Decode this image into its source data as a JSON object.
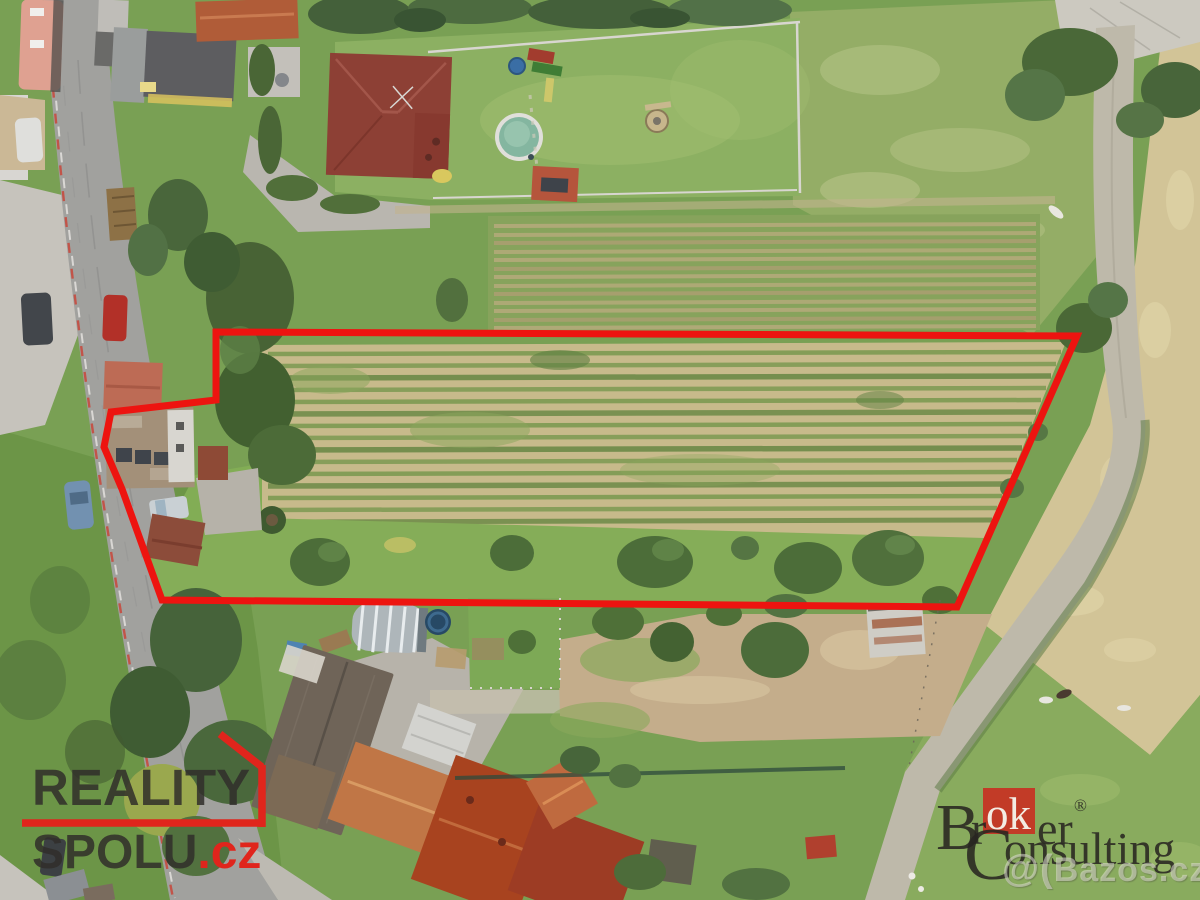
{
  "scene": {
    "alt": "Aerial drone photo of a village land plot outlined in red, with houses, gardens, crop-row fields, roads and pasture"
  },
  "annotation": {
    "plot_outline_color": "#ed1410"
  },
  "watermarks": {
    "reality_spolu": {
      "line1": "REALITY",
      "line2": "SPOLU",
      "suffix": ".cz"
    },
    "broker_consulting": {
      "b": "B",
      "r": "r",
      "ok": "ok",
      "er": "er",
      "reg": "®",
      "c": "C",
      "onsulting": "onsulting"
    },
    "bazos": {
      "prefix": "@(",
      "name": "Bazos.cz"
    }
  },
  "palette": {
    "logo_red": "#e0251c",
    "broker_red": "#c23b27",
    "dark_text": "#302e2a"
  }
}
